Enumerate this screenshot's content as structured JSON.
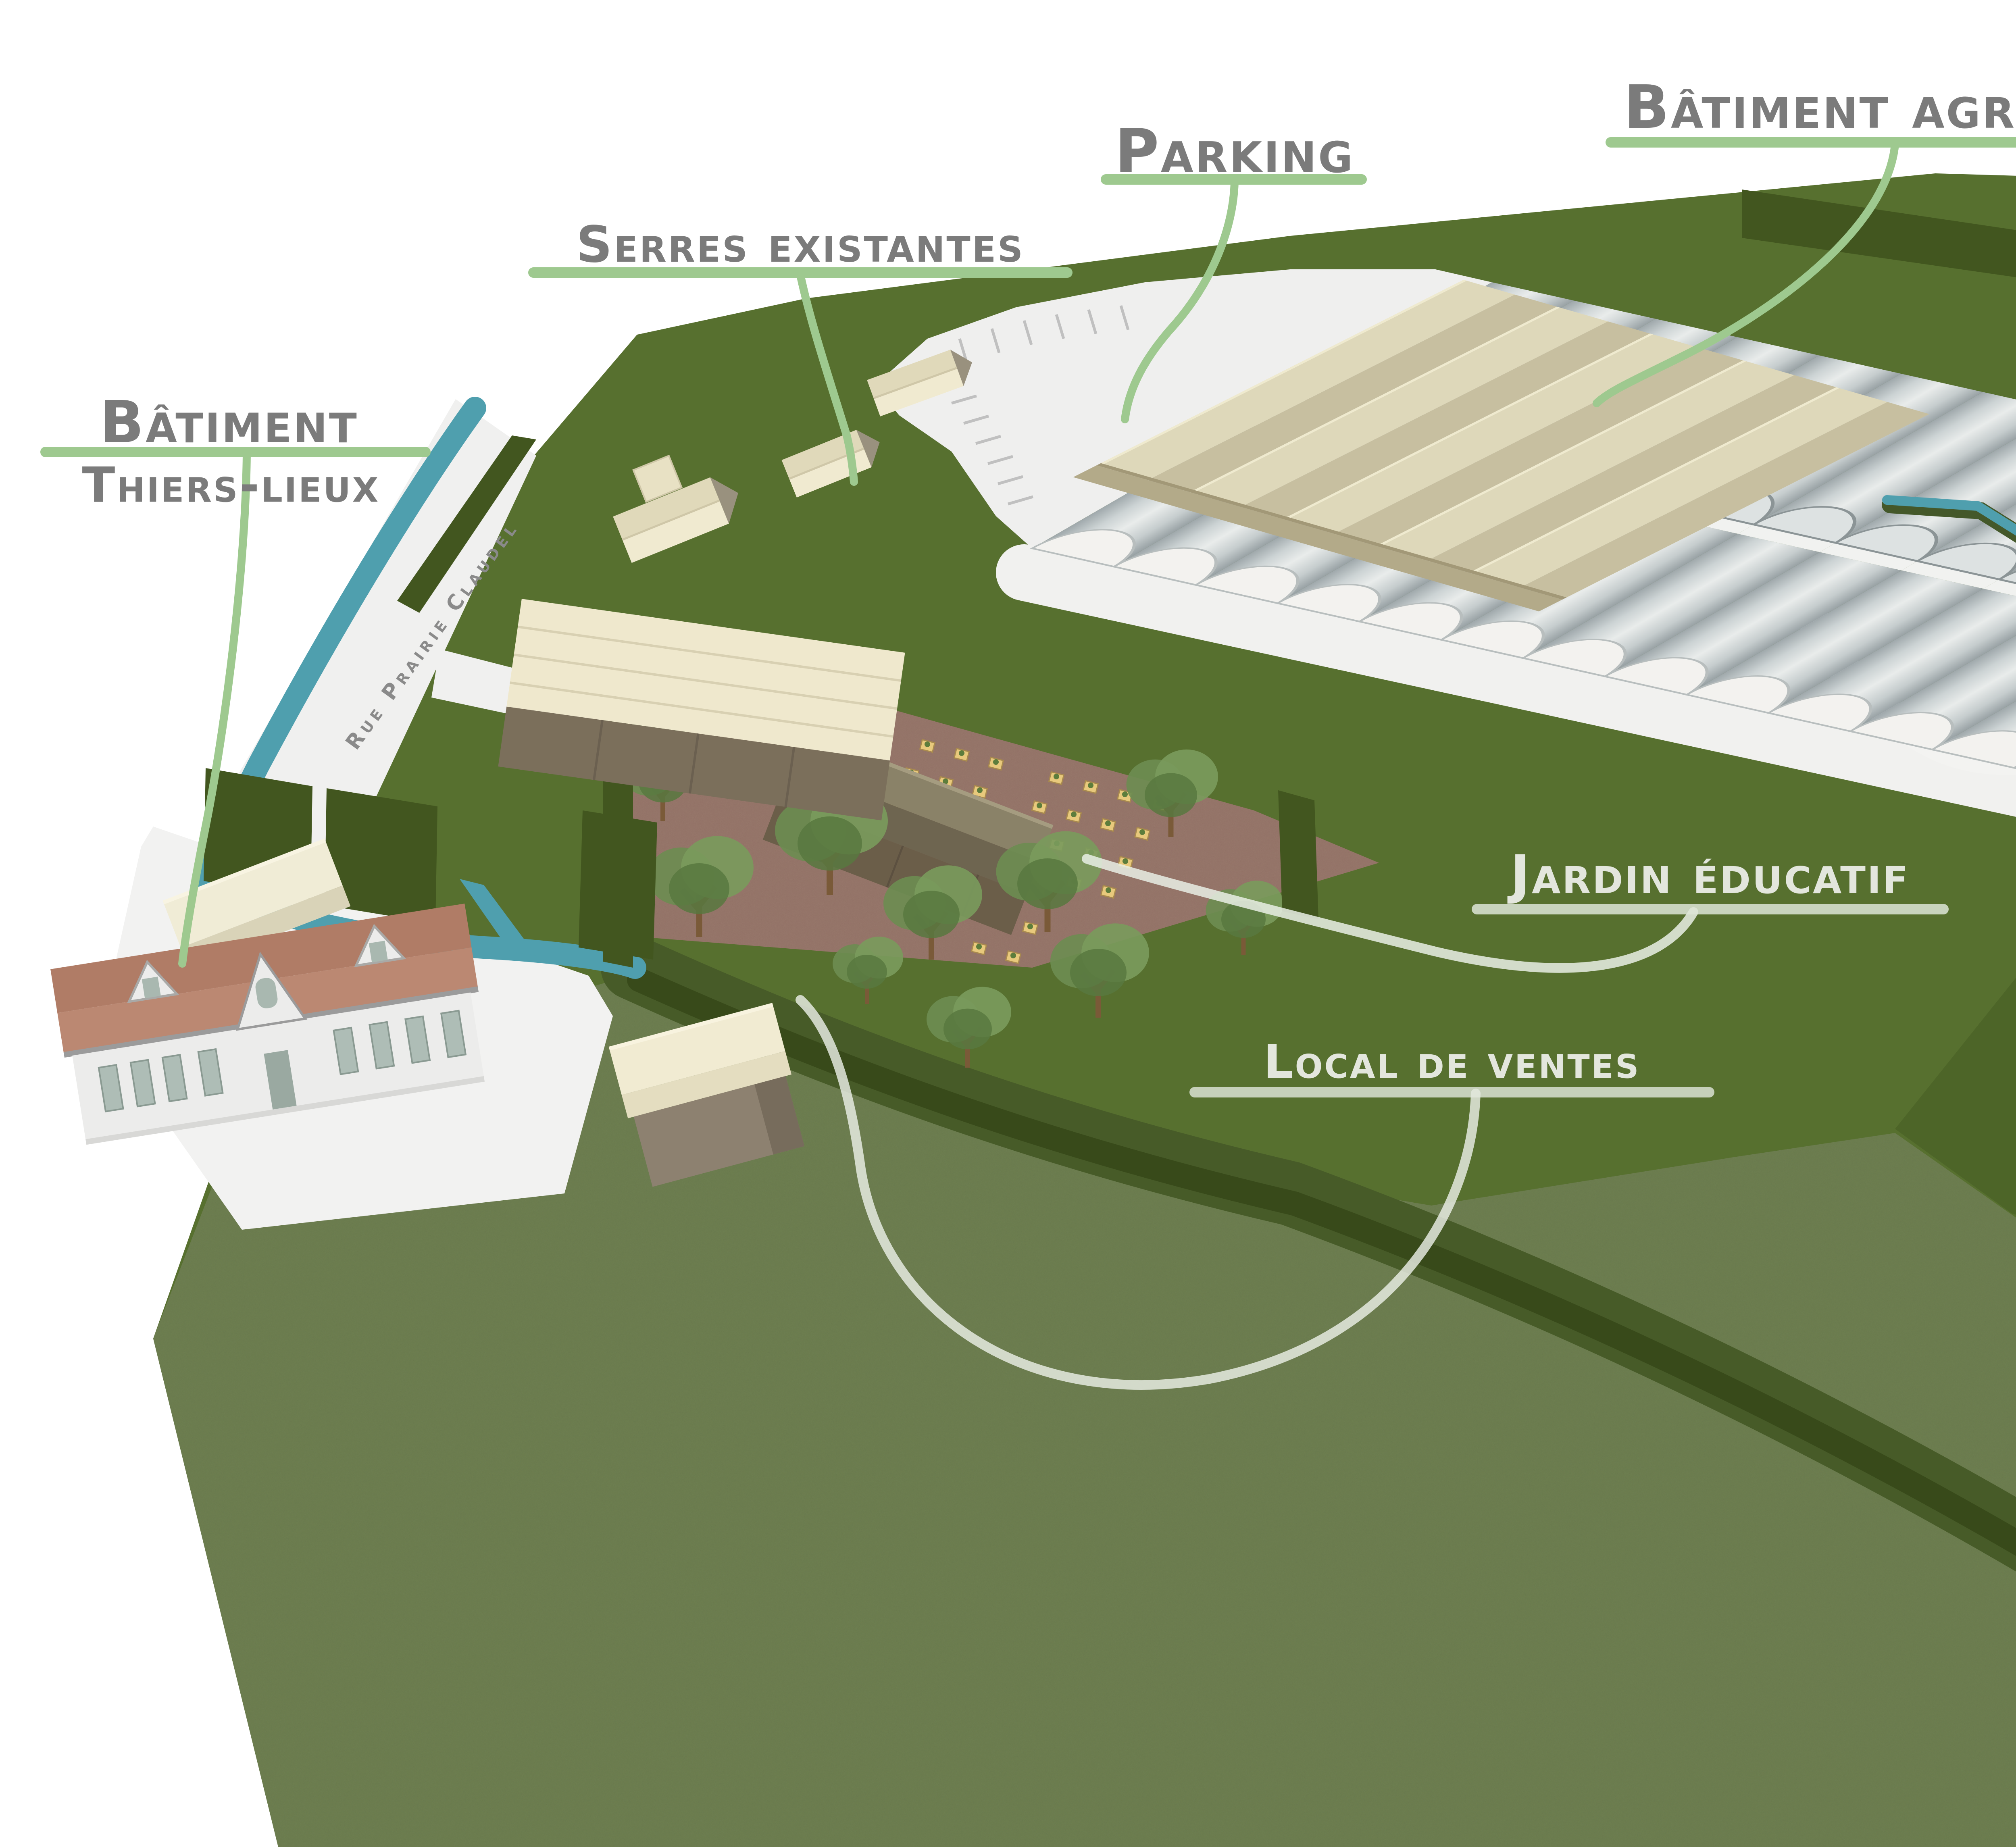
{
  "scene": {
    "type": "3d-architectural-site-plan",
    "labels": {
      "parking": "Parking",
      "batiment_agricole": "Bâtiment agricole",
      "serres": "Serres",
      "serres_existantes": "Serres existantes",
      "batiment_thiers_line1": "Bâtiment",
      "batiment_thiers_line2": "Thiers-lieux",
      "jardin_educatif": "Jardin éducatif",
      "local_de_ventes": "Local de ventes",
      "street_name": "Rue Prairie Claudel"
    },
    "features": [
      "parking lot",
      "agricultural building",
      "greenhouses",
      "existing greenhouses",
      "Thiers-lieux building",
      "educational garden",
      "sales building",
      "river",
      "meadow"
    ]
  },
  "logo": {
    "left_text": "Conseil - Conception",
    "digit": "3",
    "right_text": "Coordination",
    "company_name": "Trois C"
  },
  "colors": {
    "label_green": "#9ec98f",
    "label_gray": "#7b7b7b",
    "label_white": "#e3e6dd",
    "river_teal": "#4f9fae",
    "field_green": "#57702f",
    "field_light": "#76855a",
    "field_dark": "#4c6428",
    "hedge_dark": "#42561f",
    "garden_soil": "#9b7a6e",
    "planter_tan": "#e8c97c",
    "agri_roof_beige": "#ded8ba",
    "greenhouse_gray": "#dfe3e4",
    "tile_roof": "#b07c66",
    "cream_roof": "#f0ead0",
    "logo_red": "#e8401a",
    "logo_green": "#56c22e",
    "logo_blue": "#2b3ce6"
  }
}
